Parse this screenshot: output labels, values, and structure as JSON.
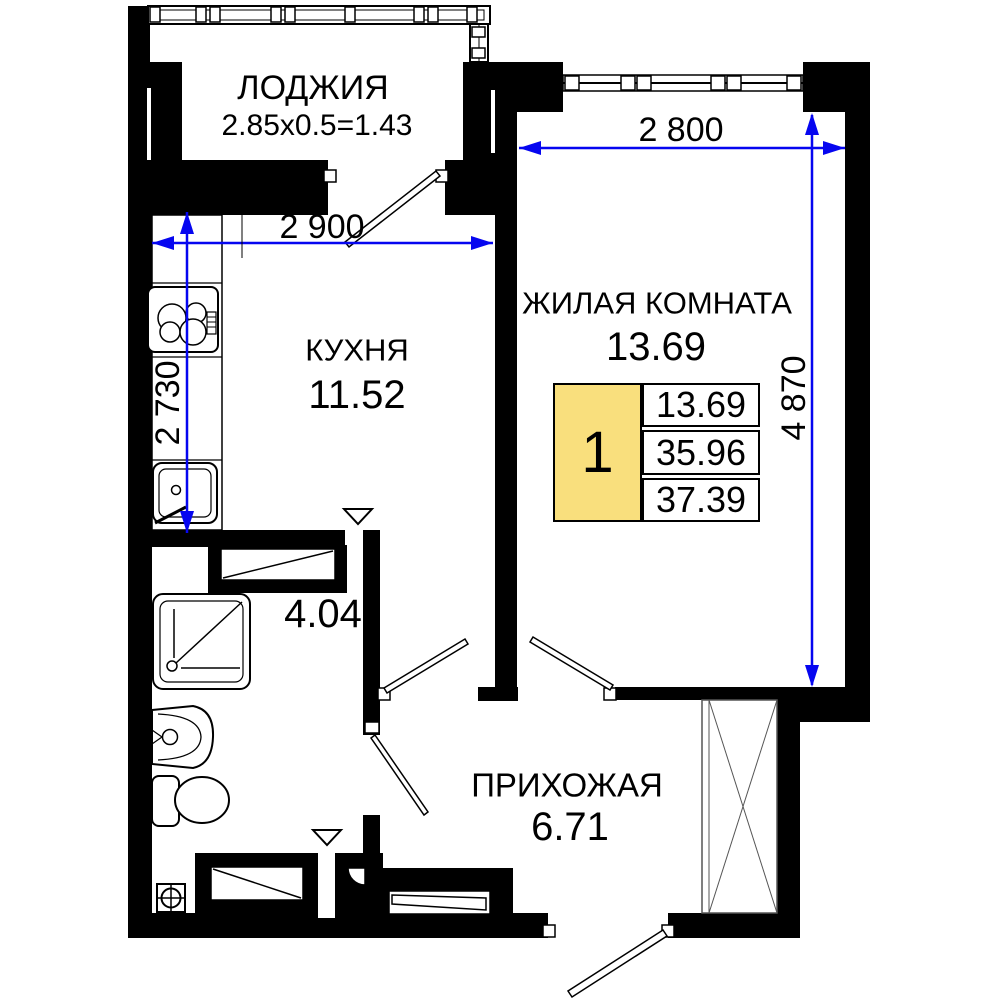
{
  "plan": {
    "rooms": {
      "loggia": {
        "name": "ЛОДЖИЯ",
        "calc": "2.85x0.5=1.43"
      },
      "kitchen": {
        "name": "КУХНЯ",
        "area": "11.52"
      },
      "living": {
        "name": "ЖИЛАЯ КОМНАТА",
        "area": "13.69"
      },
      "hallway": {
        "name": "ПРИХОЖАЯ",
        "area": "6.71"
      },
      "bathroom": {
        "area": "4.04"
      }
    },
    "dimensions": {
      "kitchen_width": "2 900",
      "kitchen_depth": "2 730",
      "living_width": "2 800",
      "living_depth": "4 870"
    },
    "info_box": {
      "rooms_count": "1",
      "living_area": "13.69",
      "area_without_loggia": "35.96",
      "total_area": "37.39"
    },
    "colors": {
      "dimension": "#0606F0",
      "highlight": "#F9DF7D",
      "walls": "#000000"
    }
  }
}
